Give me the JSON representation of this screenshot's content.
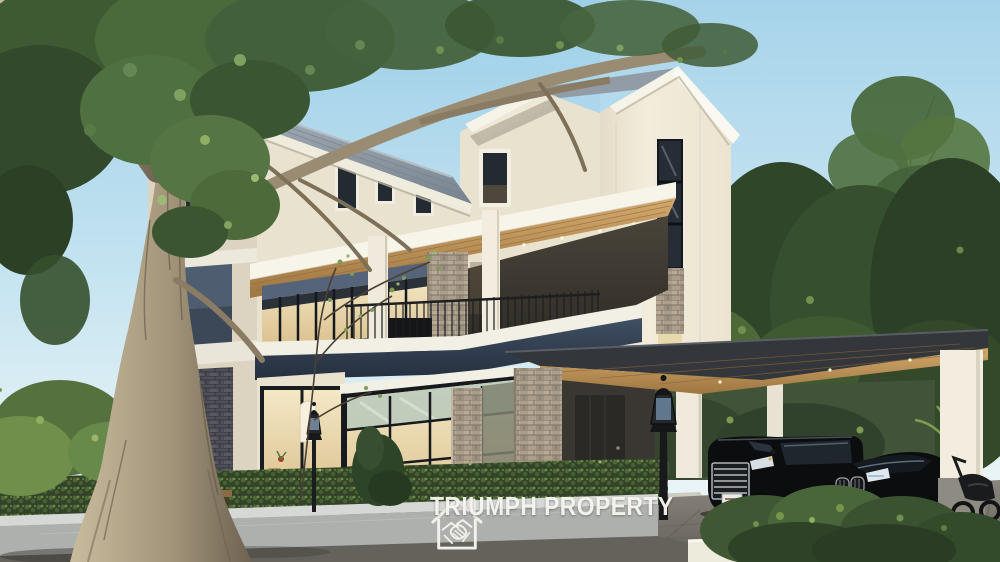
{
  "watermark": {
    "brand": "TRIUMPH PROPERTY",
    "icon": "house-handshake-icon"
  },
  "scene": {
    "type": "architectural-exterior-render",
    "subject": "three-storey modern villa with covered carport",
    "vehicles_visible": 2,
    "people_visible": 1,
    "garden_lamps_visible": 2
  },
  "palette": {
    "sky_top": "#9dcfe8",
    "sky_mid": "#c6e4f1",
    "sky_horizon": "#e9f4f6",
    "wall_cream": "#e9e2cf",
    "wall_side": "#dcd4c0",
    "wall_bright": "#f1ebda",
    "fascia_white": "#f6f3e9",
    "roof_gray": "#8e99a4",
    "accent_navy": "#354255",
    "wood_ceiling": "#c49a5f",
    "stone_warm": "#ab9f8c",
    "stone_dark": "#4f4f58",
    "glass_warm": "#f0e2b6",
    "glass_dark": "#232a32",
    "foliage_dark": "#2e4227",
    "foliage_mid": "#4c6a3a",
    "foliage_light": "#6f9150",
    "trunk_light": "#b4a687",
    "road_gray": "#65625c",
    "fence_wall_gray": "#b4b6b3",
    "driveway_gray": "#7b776e",
    "car_black": "#0b0d0f",
    "watermark_white": "#f5f4ef"
  }
}
